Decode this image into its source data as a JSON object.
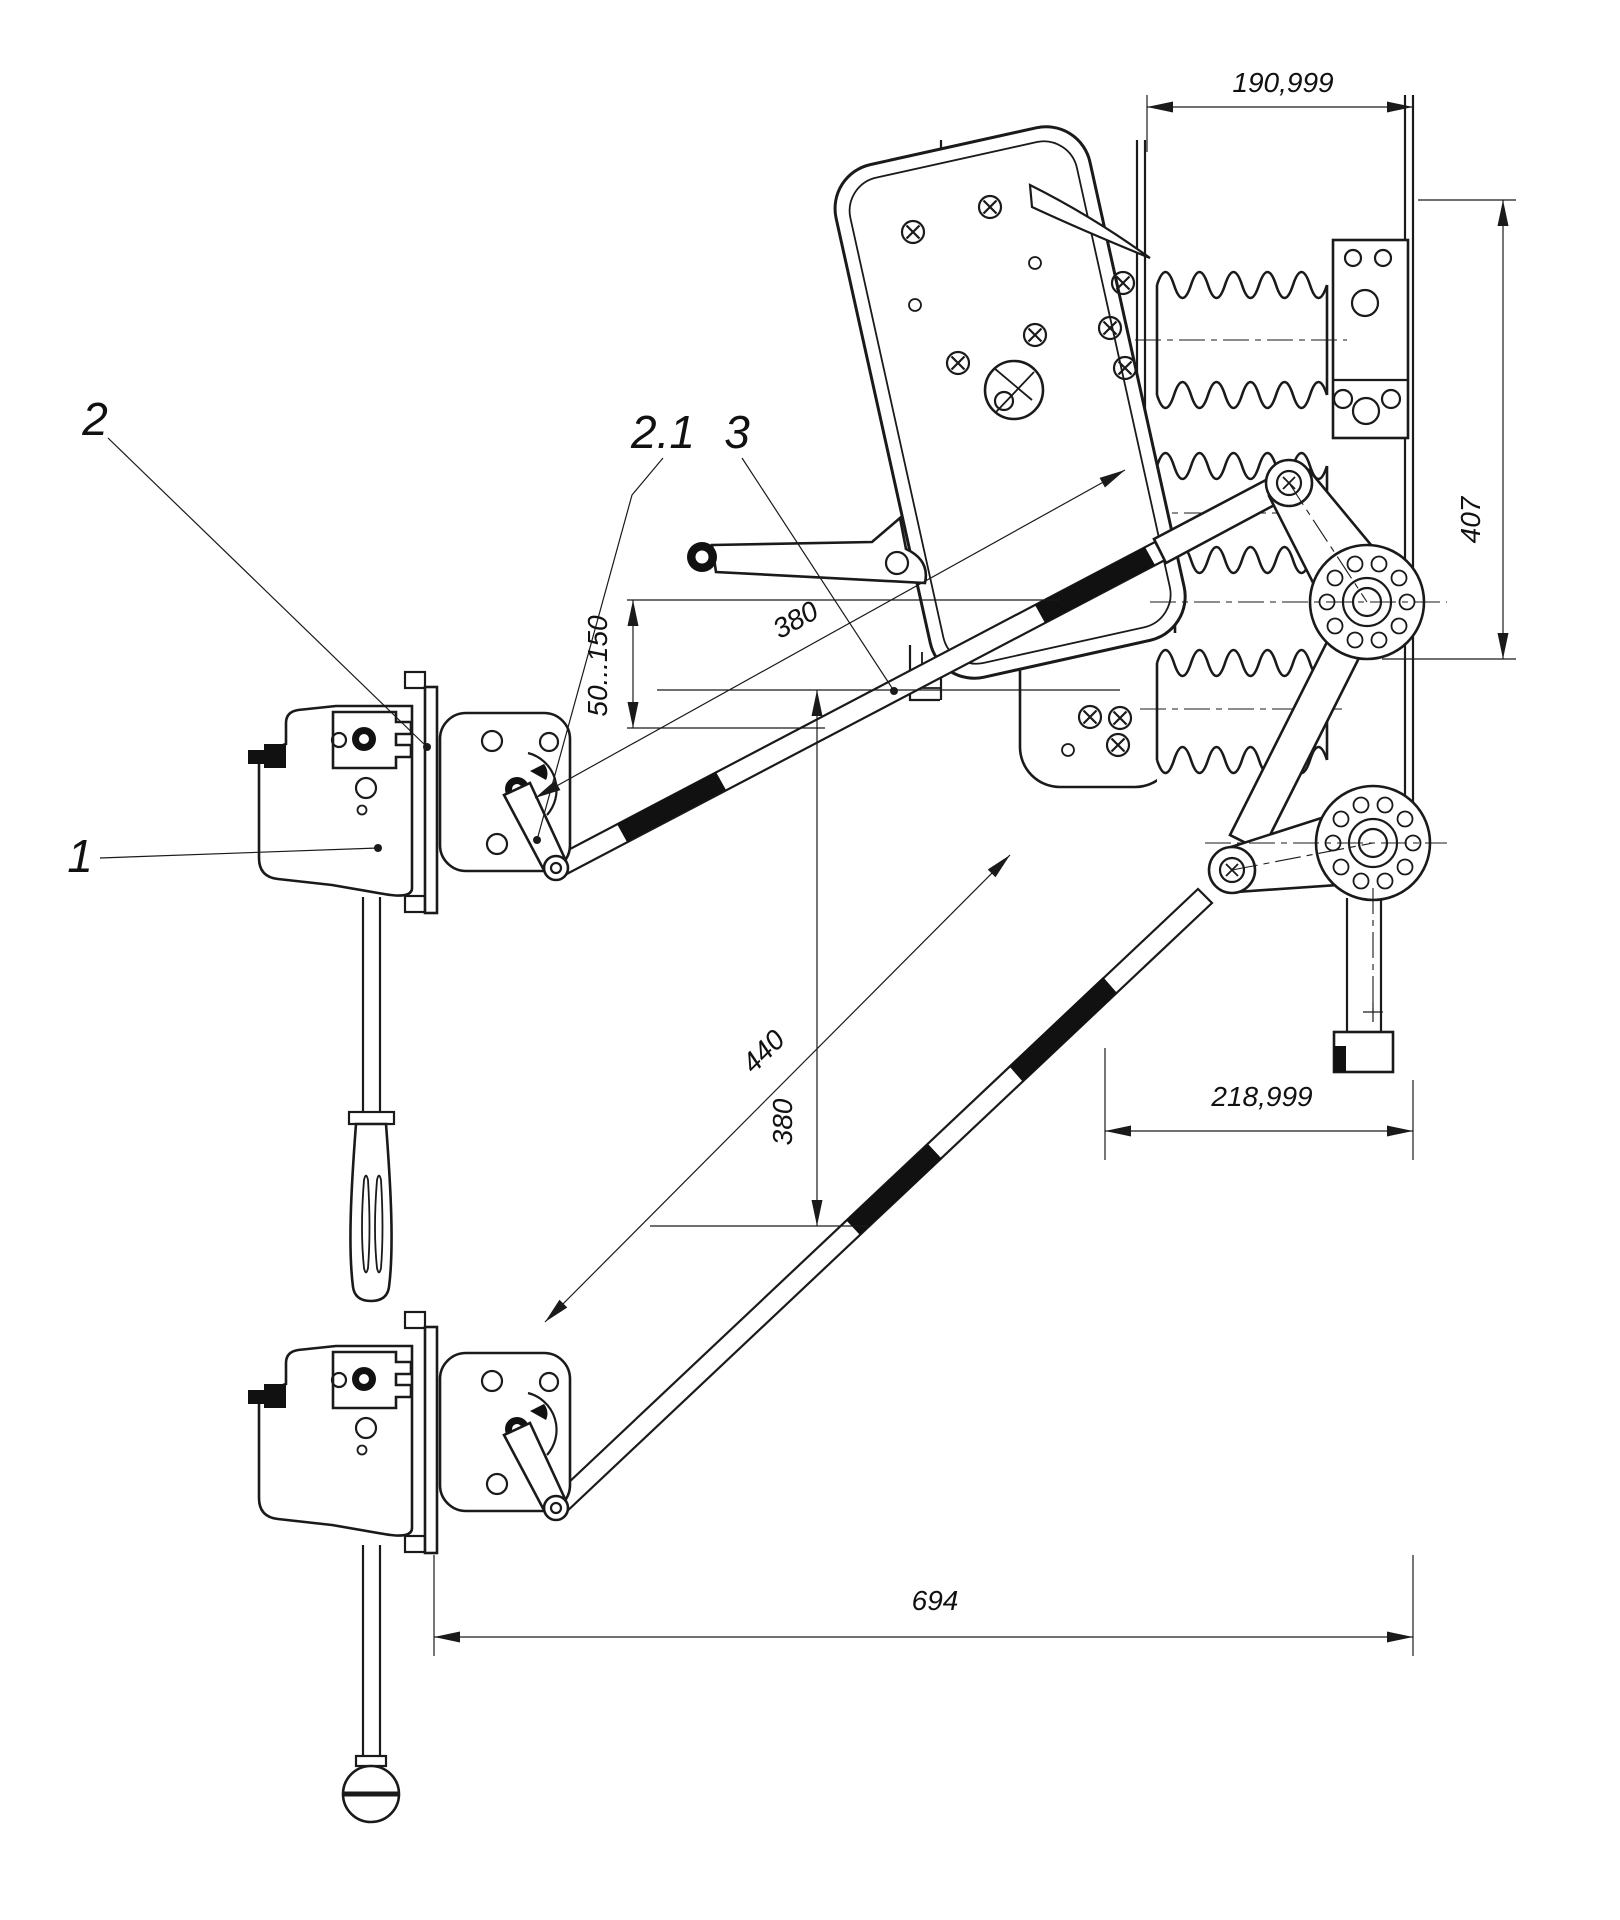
{
  "drawing": {
    "callouts": {
      "c1": "1",
      "c2": "2",
      "c21": "2.1",
      "c3": "3"
    },
    "dimensions": {
      "top_width": "190,999",
      "right_height": "407",
      "stroke_range": "50...150",
      "upper_rod_length": "380",
      "lower_diagonal_length": "440",
      "lower_vertical": "380",
      "mid_width": "218,999",
      "overall_width": "694"
    },
    "colors": {
      "line": "#1a1a1a",
      "background": "#ffffff"
    }
  }
}
